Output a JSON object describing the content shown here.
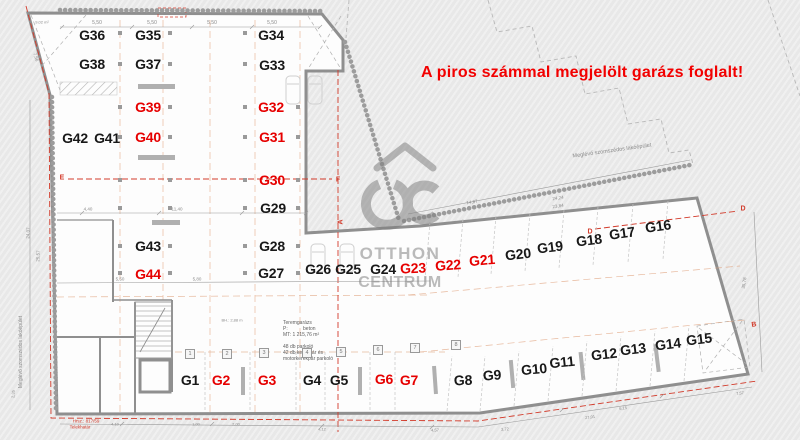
{
  "banner": {
    "text": "A piros számmal megjelölt garázs foglalt!",
    "color": "#f20000"
  },
  "watermark": {
    "line1": "OTTHON",
    "line2": "CENTRUM",
    "color": "#7e7e7e"
  },
  "colors": {
    "occupied_label": "#e60000",
    "free_label": "#181818",
    "boundary_red": "#d23a2a"
  },
  "legend": {
    "occupied_means": "red number = occupied garage"
  },
  "garages": [
    {
      "id": "G36",
      "x": 92,
      "y": 35,
      "red": false,
      "rot": 0
    },
    {
      "id": "G35",
      "x": 148,
      "y": 35,
      "red": false,
      "rot": 0
    },
    {
      "id": "G34",
      "x": 271,
      "y": 35,
      "red": false,
      "rot": 0
    },
    {
      "id": "G38",
      "x": 92,
      "y": 64,
      "red": false,
      "rot": 0
    },
    {
      "id": "G37",
      "x": 148,
      "y": 64,
      "red": false,
      "rot": 0
    },
    {
      "id": "G33",
      "x": 272,
      "y": 65,
      "red": false,
      "rot": 0
    },
    {
      "id": "G39",
      "x": 148,
      "y": 107,
      "red": true,
      "rot": 0
    },
    {
      "id": "G32",
      "x": 271,
      "y": 107,
      "red": true,
      "rot": 0
    },
    {
      "id": "G42",
      "x": 75,
      "y": 138,
      "red": false,
      "rot": 0
    },
    {
      "id": "G41",
      "x": 107,
      "y": 138,
      "red": false,
      "rot": 0
    },
    {
      "id": "G40",
      "x": 148,
      "y": 137,
      "red": true,
      "rot": 0
    },
    {
      "id": "G31",
      "x": 272,
      "y": 137,
      "red": true,
      "rot": 0
    },
    {
      "id": "G30",
      "x": 272,
      "y": 180,
      "red": true,
      "rot": 0
    },
    {
      "id": "G29",
      "x": 273,
      "y": 208,
      "red": false,
      "rot": 0
    },
    {
      "id": "G43",
      "x": 148,
      "y": 246,
      "red": false,
      "rot": 0
    },
    {
      "id": "G28",
      "x": 272,
      "y": 246,
      "red": false,
      "rot": 0
    },
    {
      "id": "G44",
      "x": 148,
      "y": 274,
      "red": true,
      "rot": 0
    },
    {
      "id": "G27",
      "x": 271,
      "y": 273,
      "red": false,
      "rot": 0
    },
    {
      "id": "G26",
      "x": 318,
      "y": 269,
      "red": false,
      "rot": 0
    },
    {
      "id": "G25",
      "x": 348,
      "y": 269,
      "red": false,
      "rot": 0
    },
    {
      "id": "G24",
      "x": 383,
      "y": 269,
      "red": false,
      "rot": 0
    },
    {
      "id": "G23",
      "x": 413,
      "y": 268,
      "red": true,
      "rot": -2
    },
    {
      "id": "G22",
      "x": 448,
      "y": 265,
      "red": true,
      "rot": -4
    },
    {
      "id": "G21",
      "x": 482,
      "y": 260,
      "red": true,
      "rot": -5
    },
    {
      "id": "G20",
      "x": 518,
      "y": 254,
      "red": false,
      "rot": -6
    },
    {
      "id": "G19",
      "x": 550,
      "y": 247,
      "red": false,
      "rot": -7
    },
    {
      "id": "G18",
      "x": 589,
      "y": 240,
      "red": false,
      "rot": -7
    },
    {
      "id": "G17",
      "x": 622,
      "y": 233,
      "red": false,
      "rot": -8
    },
    {
      "id": "G16",
      "x": 658,
      "y": 226,
      "red": false,
      "rot": -8
    },
    {
      "id": "G1",
      "x": 190,
      "y": 380,
      "red": false,
      "rot": 0
    },
    {
      "id": "G2",
      "x": 221,
      "y": 380,
      "red": true,
      "rot": 0
    },
    {
      "id": "G3",
      "x": 267,
      "y": 380,
      "red": true,
      "rot": 0
    },
    {
      "id": "G4",
      "x": 312,
      "y": 380,
      "red": false,
      "rot": 0
    },
    {
      "id": "G5",
      "x": 339,
      "y": 380,
      "red": false,
      "rot": 0
    },
    {
      "id": "G6",
      "x": 384,
      "y": 379,
      "red": true,
      "rot": 0
    },
    {
      "id": "G7",
      "x": 409,
      "y": 380,
      "red": true,
      "rot": 0
    },
    {
      "id": "G8",
      "x": 463,
      "y": 380,
      "red": false,
      "rot": -2
    },
    {
      "id": "G9",
      "x": 492,
      "y": 375,
      "red": false,
      "rot": -4
    },
    {
      "id": "G10",
      "x": 534,
      "y": 369,
      "red": false,
      "rot": -5
    },
    {
      "id": "G11",
      "x": 562,
      "y": 362,
      "red": false,
      "rot": -6
    },
    {
      "id": "G12",
      "x": 604,
      "y": 354,
      "red": false,
      "rot": -6
    },
    {
      "id": "G13",
      "x": 633,
      "y": 349,
      "red": false,
      "rot": -7
    },
    {
      "id": "G14",
      "x": 668,
      "y": 344,
      "red": false,
      "rot": -7
    },
    {
      "id": "G15",
      "x": 699,
      "y": 339,
      "red": false,
      "rot": -7
    }
  ],
  "grid_bubbles": [
    {
      "n": "1",
      "x": 190,
      "y": 354
    },
    {
      "n": "2",
      "x": 227,
      "y": 354
    },
    {
      "n": "3",
      "x": 264,
      "y": 353
    },
    {
      "n": "4",
      "x": 307,
      "y": 353
    },
    {
      "n": "5",
      "x": 341,
      "y": 352
    },
    {
      "n": "6",
      "x": 378,
      "y": 350
    },
    {
      "n": "7",
      "x": 415,
      "y": 348
    },
    {
      "n": "8",
      "x": 456,
      "y": 345
    }
  ],
  "section_markers": [
    {
      "t": "E",
      "x": 62,
      "y": 178,
      "r": 0
    },
    {
      "t": "F",
      "x": 338,
      "y": 180,
      "r": 0
    },
    {
      "t": "A",
      "x": 341,
      "y": 222,
      "r": -90
    },
    {
      "t": "D",
      "x": 590,
      "y": 232,
      "r": 0
    },
    {
      "t": "D",
      "x": 743,
      "y": 209,
      "r": 0
    },
    {
      "t": "B",
      "x": 754,
      "y": 325,
      "r": -8
    }
  ],
  "annotations": [
    {
      "t": "5,50",
      "x": 97,
      "y": 23,
      "r": 0,
      "s": 5
    },
    {
      "t": "5,50",
      "x": 152,
      "y": 23,
      "r": 0,
      "s": 5
    },
    {
      "t": "5,50",
      "x": 212,
      "y": 23,
      "r": 0,
      "s": 5
    },
    {
      "t": "5,50",
      "x": 272,
      "y": 23,
      "r": 0,
      "s": 5
    },
    {
      "t": "9,02 m²",
      "x": 42,
      "y": 22,
      "r": 0,
      "s": 4
    },
    {
      "t": "4,40",
      "x": 88,
      "y": 209,
      "r": 0,
      "s": 4.5
    },
    {
      "t": "11,40",
      "x": 177,
      "y": 209,
      "r": 0,
      "s": 4.5
    },
    {
      "t": "5,50",
      "x": 120,
      "y": 279,
      "r": 0,
      "s": 4.5
    },
    {
      "t": "5,80",
      "x": 197,
      "y": 279,
      "r": 0,
      "s": 4.5
    },
    {
      "t": "BH.: 2,88 m",
      "x": 232,
      "y": 320,
      "r": 0,
      "s": 4
    },
    {
      "t": "14,87",
      "x": 472,
      "y": 202,
      "r": -8,
      "s": 4.5
    },
    {
      "t": "24,24",
      "x": 558,
      "y": 198,
      "r": -8,
      "s": 4.5
    },
    {
      "t": "23,84",
      "x": 558,
      "y": 206,
      "r": -8,
      "s": 4.5
    },
    {
      "t": "Meglévő szomszédos lakóépület",
      "x": 612,
      "y": 151,
      "r": -8,
      "s": 5.5
    },
    {
      "t": "Meglévő szomszédos lakóépület",
      "x": 21,
      "y": 352,
      "r": -90,
      "s": 5
    },
    {
      "t": "7,56",
      "x": 36,
      "y": 57,
      "r": 72,
      "s": 4.5
    },
    {
      "t": "24,07",
      "x": 28,
      "y": 233,
      "r": -87,
      "s": 4.5
    },
    {
      "t": "25,57",
      "x": 38,
      "y": 256,
      "r": -87,
      "s": 4.5
    },
    {
      "t": "2,35",
      "x": 13,
      "y": 394,
      "r": -87,
      "s": 4
    },
    {
      "t": "35,78",
      "x": 744,
      "y": 283,
      "r": -81,
      "s": 4.5
    },
    {
      "t": "4,10",
      "x": 115,
      "y": 424,
      "r": 0,
      "s": 4
    },
    {
      "t": "1,00",
      "x": 196,
      "y": 424,
      "r": 0,
      "s": 4
    },
    {
      "t": "2,00",
      "x": 236,
      "y": 424,
      "r": 0,
      "s": 4
    },
    {
      "t": "4,12",
      "x": 322,
      "y": 429,
      "r": 0,
      "s": 4
    },
    {
      "t": "4,57",
      "x": 435,
      "y": 430,
      "r": -2,
      "s": 4
    },
    {
      "t": "3,72",
      "x": 505,
      "y": 429,
      "r": -3,
      "s": 4
    },
    {
      "t": "27,01",
      "x": 590,
      "y": 417,
      "r": -7,
      "s": 4
    },
    {
      "t": "6,15",
      "x": 623,
      "y": 408,
      "r": -7,
      "s": 4
    },
    {
      "t": "7,57",
      "x": 740,
      "y": 393,
      "r": -8,
      "s": 4
    },
    {
      "t": "Hrsz.: 817/59",
      "x": 86,
      "y": 421,
      "r": 0,
      "s": 4.5,
      "red": true
    },
    {
      "t": "Telekhatár",
      "x": 80,
      "y": 427,
      "r": 0,
      "s": 4.5,
      "red": true
    }
  ],
  "info_block": {
    "lines": [
      "Teremgarázs",
      "P:           beton",
      "MT: 1 215,76 m²",
      "",
      "48 db parkoló",
      "42 db kerékpár és",
      "motorkerékpár parkoló"
    ]
  }
}
